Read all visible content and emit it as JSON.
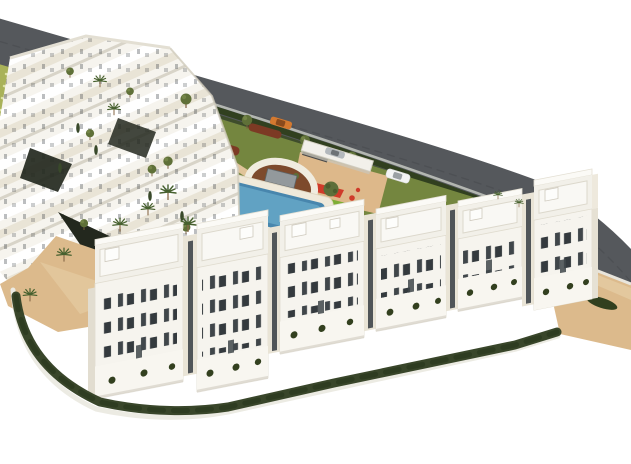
{
  "scene": {
    "type": "3d-architectural-rendering",
    "view": "aerial-isometric",
    "subject": "Modern white residential apartment complex with communal gardens, swimming pools, children's playground, circular plaza and a perimeter road",
    "elements": {
      "road": {
        "label": "perimeter road",
        "cars": [
          "orange car",
          "silver car",
          "white car"
        ]
      },
      "buildings": {
        "front_row_blocks": 6,
        "front_row_style": "white 4-5 storey apartment blocks with roof terraces and dark vertical windows",
        "back_cluster": "stepped terraced white apartment cluster on a slope"
      },
      "amenities": [
        "main swimming pool with sun deck",
        "small secondary pool",
        "children playground with red, green and yellow equipment",
        "circular plaza with stone monument",
        "lawned gardens with sandy paths",
        "palm trees and olive trees",
        "terraced green slope with steps",
        "perimeter hedges"
      ]
    },
    "colors": {
      "background": "#ffffff",
      "road": "#55585c",
      "road_marking": "#45484c",
      "road_wall": "#b3b6b1",
      "hedge_dark": "#31401f",
      "hedge_mid": "#3c4d26",
      "boundary_hedge": "#39462a",
      "terrace_slope": "#a9b259",
      "terrace_step": "#dfe4a8",
      "building_white": "#f6f4ee",
      "building_cream": "#e9e4d6",
      "building_shadow": "#d8d4c8",
      "window_dark": "#40464a",
      "window_mid": "#343a3e",
      "glass": "#3f454a",
      "lawn": "#74863f",
      "lawn_light": "#8b9c52",
      "sand": "#dcba8c",
      "sand_light": "#e6cfa5",
      "path_tan": "#e0c49a",
      "playground_sand": "#ddb88a",
      "pool": "#4886ad",
      "pool_light": "#6fb0cf",
      "pool_deck": "#efe9da",
      "palm": "#46602e",
      "tree": "#5f7038",
      "olive": "#5d6f3a",
      "shrub_red": "#7c3a24",
      "plaza_soil": "#7d4a2c",
      "plaza_ring": "#f0ecdf",
      "stone": "#93999c",
      "play_red": "#cf3b2a",
      "play_green": "#7fae35",
      "play_yellow": "#d8b62e",
      "car_orange": "#d4792f",
      "car_silver": "#b3b8bc",
      "car_white": "#f3f4f4",
      "dark_bed": "#23281e",
      "roof_light": "#f2f0e9",
      "roof_inner": "#f9f8f4",
      "roof_edge": "#dcd8cc"
    }
  }
}
